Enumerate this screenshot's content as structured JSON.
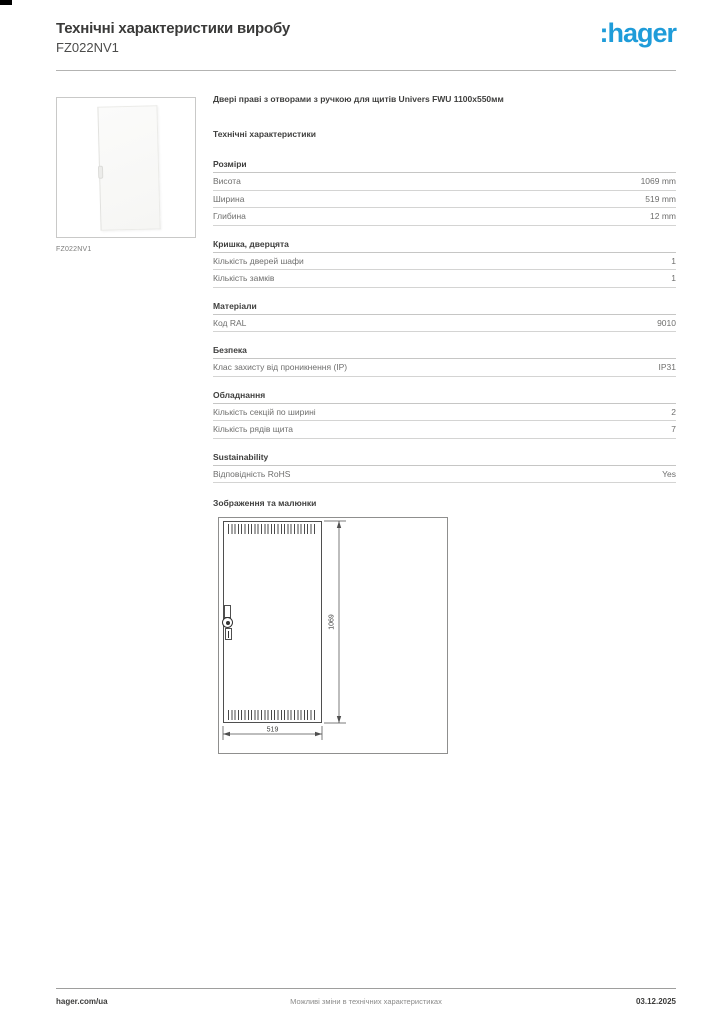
{
  "brand": {
    "logo_text": ":hager",
    "brand_color": "#1f9cd9"
  },
  "header": {
    "title": "Технічні характеристики виробу",
    "product_code": "FZ022NV1"
  },
  "product": {
    "image_caption": "FZ022NV1",
    "description": "Двері праві з отворами з ручкою для щитів Univers FWU 1100x550мм"
  },
  "specs": {
    "heading": "Технічні характеристики",
    "sections": [
      {
        "title": "Розміри",
        "rows": [
          {
            "label": "Висота",
            "value": "1069 mm"
          },
          {
            "label": "Ширина",
            "value": "519 mm"
          },
          {
            "label": "Глибина",
            "value": "12 mm"
          }
        ]
      },
      {
        "title": "Кришка, дверцята",
        "rows": [
          {
            "label": "Кількість дверей шафи",
            "value": "1"
          },
          {
            "label": "Кількість замків",
            "value": "1"
          }
        ]
      },
      {
        "title": "Матеріали",
        "rows": [
          {
            "label": "Код RAL",
            "value": "9010"
          }
        ]
      },
      {
        "title": "Безпека",
        "rows": [
          {
            "label": "Клас захисту від проникнення (IP)",
            "value": "IP31"
          }
        ]
      },
      {
        "title": "Обладнання",
        "rows": [
          {
            "label": "Кількість секцій по ширині",
            "value": "2"
          },
          {
            "label": "Кількість рядів щита",
            "value": "7"
          }
        ]
      },
      {
        "title": "Sustainability",
        "rows": [
          {
            "label": "Відповідність RoHS",
            "value": "Yes"
          }
        ]
      }
    ]
  },
  "drawing": {
    "heading": "Зображення та малюнки",
    "height_label": "1069",
    "width_label": "519"
  },
  "footer": {
    "website": "hager.com/ua",
    "disclaimer": "Можливі зміни в технічних характеристиках",
    "date": "03.12.2025"
  }
}
